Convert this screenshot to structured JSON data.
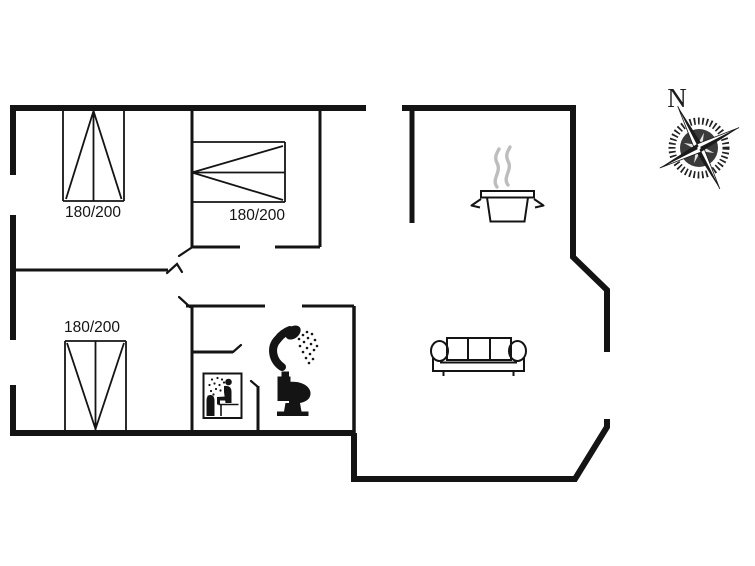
{
  "colors": {
    "ink": "#141414",
    "steam": "#bdbdbd",
    "background": "#ffffff"
  },
  "compass": {
    "north_label": "N"
  },
  "beds": [
    {
      "room": "bedroom-top-left",
      "size_label": "180/200"
    },
    {
      "room": "bedroom-top-middle",
      "size_label": "180/200"
    },
    {
      "room": "bedroom-bottom-left",
      "size_label": "180/200"
    }
  ],
  "icons": {
    "kitchen": "cooking-pot-icon",
    "living_room": "sofa-icon",
    "bathroom": [
      "shower-icon",
      "toilet-icon",
      "sauna-icon"
    ],
    "orientation": "compass-rose-icon"
  }
}
